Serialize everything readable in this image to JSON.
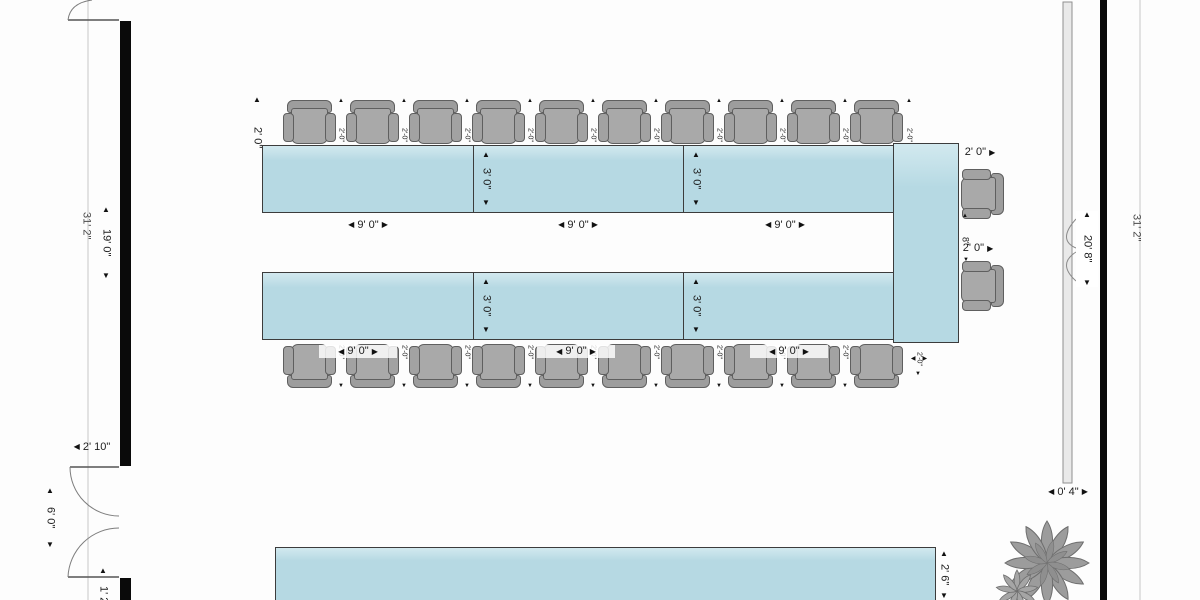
{
  "floor_plan": {
    "title": "conference-room-u-shape-floor-plan",
    "dims": {
      "room_side": "31' 2\"",
      "wall_segment": "19' 0\"",
      "door_width": "2' 10\"",
      "door_opening": "6' 0\"",
      "wall_stub": "1' 2\"",
      "section_length": "9' 0\"",
      "section_depth": "3' 0\"",
      "chair_width": "2' 0\"",
      "chair_gap": "2'-0\"",
      "head_gap": "8\"",
      "board_length": "20' 8\"",
      "board_depth": "0' 4\"",
      "back_table_depth": "2' 6\""
    },
    "icons": {
      "up": "▲",
      "down": "▼",
      "left": "◀",
      "right": "▶"
    },
    "counts": {
      "top_chairs": 10,
      "bottom_chairs": 10,
      "head_chairs": 2,
      "table_sections_per_side": 3,
      "whiteboards": 1,
      "plants": 1
    },
    "colors": {
      "table_fill": "#b6d9e3",
      "chair_fill": "#a9a9a9",
      "wall": "#0a0a0a",
      "board_fill": "#e9e9e9",
      "dim_text": "#1c1c1c"
    }
  }
}
